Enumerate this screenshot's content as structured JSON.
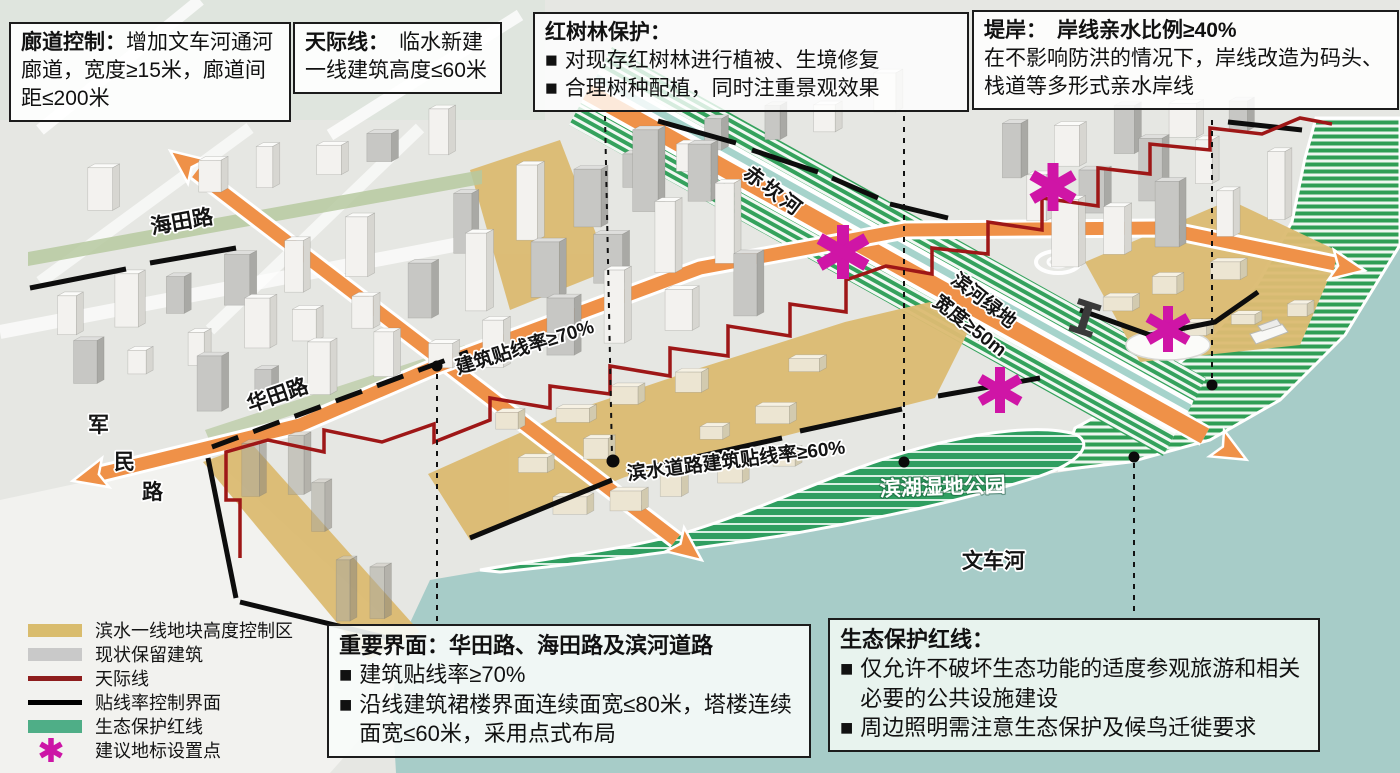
{
  "ui": {
    "bullet": "■"
  },
  "callouts": {
    "corridor": {
      "title": "廊道控制：",
      "body": "增加文车河通河廊道，宽度≥15米，廊道间距≤200米"
    },
    "skyline": {
      "title": "天际线：",
      "body": "临水新建一线建筑高度≤60米"
    },
    "mangrove": {
      "title": "红树林保护：",
      "items": [
        "对现存红树林进行植被、生境修复",
        "合理树种配植，同时注重景观效果"
      ]
    },
    "embankment": {
      "title": "堤岸：",
      "highlight": "岸线亲水比例≥40%",
      "body": "在不影响防洪的情况下，岸线改造为码头、栈道等多形式亲水岸线"
    },
    "interface": {
      "title": "重要界面：华田路、海田路及滨河道路",
      "items": [
        "建筑贴线率≥70%",
        "沿线建筑裙楼界面连续面宽≤80米，塔楼连续面宽≤60米，采用点式布局"
      ]
    },
    "eco": {
      "title": "生态保护红线：",
      "items": [
        "仅允许不破坏生态功能的适度参观旅游和相关必要的公共设施建设",
        "周边照明需注意生态保护及候鸟迁徙要求"
      ]
    }
  },
  "legend": {
    "items": [
      {
        "label": "滨水一线地块高度控制区",
        "swatch": "#d9bc6d"
      },
      {
        "label": "现状保留建筑",
        "swatch": "#c9c9c9"
      },
      {
        "label": "天际线",
        "swatch": "#8e1d1d"
      },
      {
        "label": "贴线率控制界面",
        "swatch": "#000000"
      },
      {
        "label": "生态保护红线",
        "swatch": "#4fae87"
      },
      {
        "label": "建议地标设置点",
        "swatch": "#cc15a6"
      }
    ]
  },
  "map_labels": {
    "haitian_road": "海田路",
    "junmin_chars": [
      "军",
      "民",
      "路"
    ],
    "huatian_road": "华田路",
    "tieline_70": "建筑贴线率≥70%",
    "chikan_river": "赤坎河",
    "riverside_green_line1": "滨河绿地",
    "riverside_green_line2": "宽度≥50m",
    "waterfront_60": "滨水道路建筑贴线率≥60%",
    "wetland_park": "滨湖湿地公园",
    "wenche_river": "文车河"
  },
  "colors": {
    "road_orange": "#ef9148",
    "skyline_red": "#9e1717",
    "landmark_magenta": "#cc15a6",
    "height_control_tan": "#d9bc6d",
    "retained_building_gray": "#c9c9c9",
    "eco_green": "#4fae87",
    "water_teal": "#a7ccc8",
    "wetland_green": "#2f9e5f"
  }
}
